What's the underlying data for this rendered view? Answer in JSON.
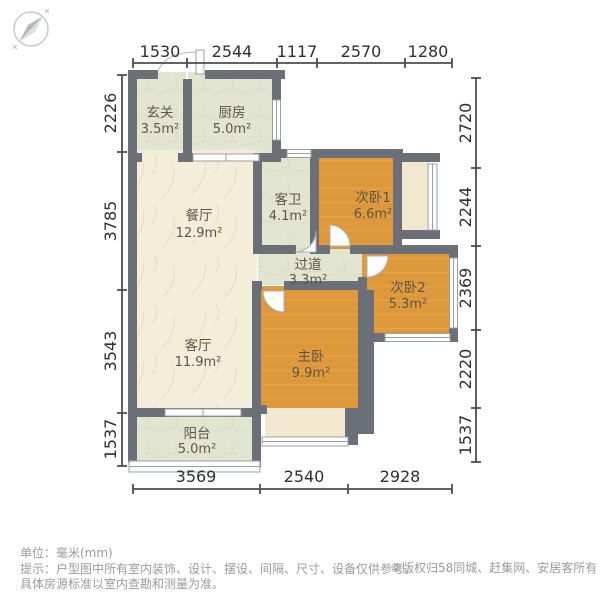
{
  "compass": {
    "icon": "compass-north-icon"
  },
  "dimensions": {
    "top": [
      "1530",
      "2544",
      "1117",
      "2570",
      "1280"
    ],
    "left": [
      "2226",
      "3785",
      "3543",
      "1537"
    ],
    "right": [
      "2720",
      "2244",
      "2369",
      "2220",
      "1537"
    ],
    "bottom": [
      "3569",
      "2540",
      "2928"
    ]
  },
  "rooms": [
    {
      "name": "玄关",
      "area": "3.5m²"
    },
    {
      "name": "厨房",
      "area": "5.0m²"
    },
    {
      "name": "餐厅",
      "area": "12.9m²"
    },
    {
      "name": "客卫",
      "area": "4.1m²"
    },
    {
      "name": "次卧1",
      "area": "6.6m²"
    },
    {
      "name": "过道",
      "area": "3.3m²"
    },
    {
      "name": "次卧2",
      "area": "5.3m²"
    },
    {
      "name": "客厅",
      "area": "11.9m²"
    },
    {
      "name": "主卧",
      "area": "9.9m²"
    },
    {
      "name": "阳台",
      "area": "5.0m²"
    }
  ],
  "footer": {
    "unit": "单位：毫米(mm)",
    "tip_line1": "提示：户型图中所有室内装饰、设计、摆设、间隔、尺寸、设备仅供参考。",
    "tip_line2": "具体房源标准以室内查勘和测量为准。",
    "copyright": "©版权归58同城、赶集网、安居客所有"
  },
  "colors": {
    "wall": "#6b6f78",
    "tile_room": "#e2e5d0",
    "wood_room": "#e09a3e",
    "marble_room": "#f4edda",
    "bay_window": "#f2e8cf",
    "dim_text": "#2f2f2f",
    "footer_text": "#9b9b9b"
  }
}
